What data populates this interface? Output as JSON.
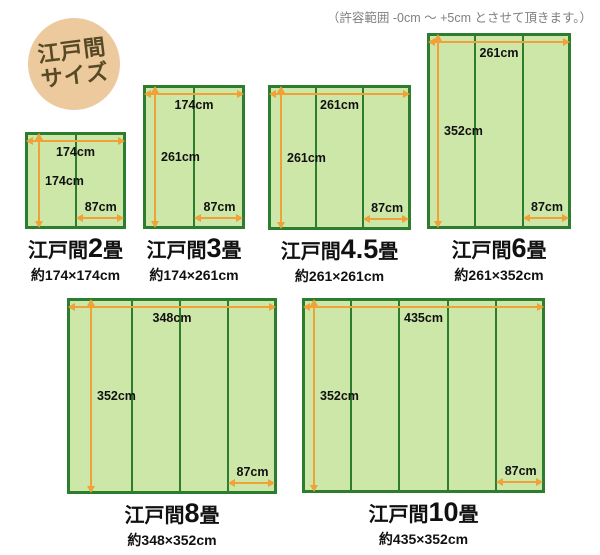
{
  "badge": {
    "line1": "江戸間",
    "line2": "サイズ"
  },
  "note": "（許容範囲 -0cm ～ +5cm とさせて頂きます。）",
  "colors": {
    "arrow_orange": "#f0a138",
    "mat_fill": "#cde7a8",
    "mat_border": "#2d7d2e",
    "badge_bg": "#edc99e",
    "badge_text": "#564a26",
    "note_gray": "#808080"
  },
  "diagrams": [
    {
      "name": "edoma-2jo",
      "title_prefix": "江戸間",
      "title_number": "2",
      "title_suffix": "畳",
      "subtitle": "約174×174cm",
      "width_label": "174cm",
      "height_label": "174cm",
      "mat_label": "87cm",
      "strips": 2,
      "layout": {
        "left": 25,
        "top": 132,
        "width": 101,
        "height": 97,
        "v_arrow_x": 13
      }
    },
    {
      "name": "edoma-3jo",
      "title_prefix": "江戸間",
      "title_number": "3",
      "title_suffix": "畳",
      "subtitle": "約174×261cm",
      "width_label": "174cm",
      "height_label": "261cm",
      "mat_label": "87cm",
      "strips": 2,
      "layout": {
        "left": 143,
        "top": 85,
        "width": 102,
        "height": 144,
        "v_arrow_x": 11
      }
    },
    {
      "name": "edoma-4-5jo",
      "title_prefix": "江戸間",
      "title_number": "4.5",
      "title_suffix": "畳",
      "subtitle": "約261×261cm",
      "width_label": "261cm",
      "height_label": "261cm",
      "mat_label": "87cm",
      "strips": 3,
      "layout": {
        "left": 268,
        "top": 85,
        "width": 143,
        "height": 145,
        "v_arrow_x": 12
      }
    },
    {
      "name": "edoma-6jo",
      "title_prefix": "江戸間",
      "title_number": "6",
      "title_suffix": "畳",
      "subtitle": "約261×352cm",
      "width_label": "261cm",
      "height_label": "352cm",
      "mat_label": "87cm",
      "strips": 3,
      "layout": {
        "left": 427,
        "top": 33,
        "width": 144,
        "height": 196,
        "v_arrow_x": 10
      }
    },
    {
      "name": "edoma-8jo",
      "title_prefix": "江戸間",
      "title_number": "8",
      "title_suffix": "畳",
      "subtitle": "約348×352cm",
      "width_label": "348cm",
      "height_label": "352cm",
      "mat_label": "87cm",
      "strips": 4,
      "divider_fracs": [
        0.31,
        0.538,
        0.767
      ],
      "layout": {
        "left": 67,
        "top": 298,
        "width": 210,
        "height": 196,
        "v_arrow_x": 23
      }
    },
    {
      "name": "edoma-10jo",
      "title_prefix": "江戸間",
      "title_number": "10",
      "title_suffix": "畳",
      "subtitle": "約435×352cm",
      "width_label": "435cm",
      "height_label": "352cm",
      "mat_label": "87cm",
      "strips": 5,
      "layout": {
        "left": 302,
        "top": 298,
        "width": 243,
        "height": 195,
        "v_arrow_x": 11
      }
    }
  ]
}
